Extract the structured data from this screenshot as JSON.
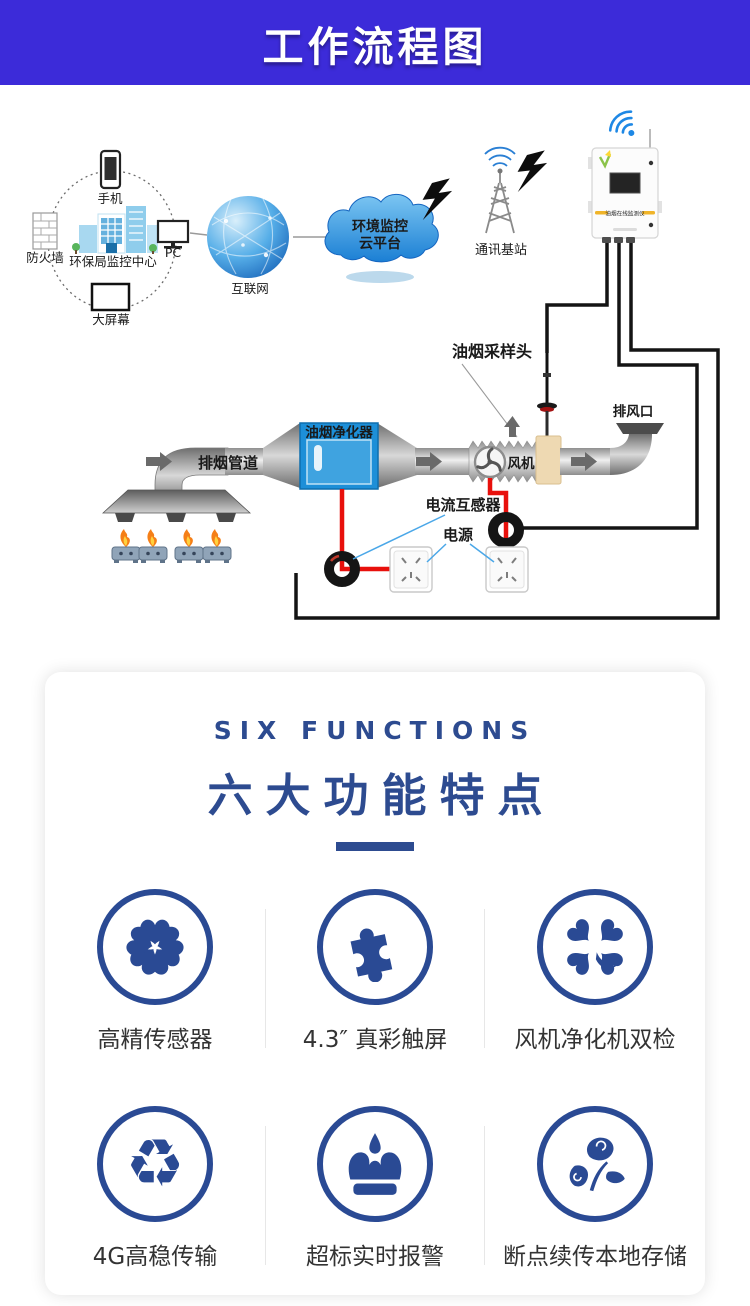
{
  "header": {
    "title": "工作流程图"
  },
  "diagram": {
    "labels": {
      "phone": "手机",
      "firewall": "防火墙",
      "monitor_center": "环保局监控中心",
      "pc": "PC",
      "big_screen": "大屏幕",
      "internet": "互联网",
      "cloud_line1": "环境监控",
      "cloud_line2": "云平台",
      "base_station": "通讯基站",
      "device_band": "油烟在线监测仪",
      "sampling_head": "油烟采样头",
      "exhaust_outlet": "排风口",
      "exhaust_duct": "排烟管道",
      "purifier": "油烟净化器",
      "fan": "风机",
      "current_transformer": "电流互感器",
      "power": "电源"
    }
  },
  "six_functions": {
    "subtitle": "SIX FUNCTIONS",
    "title": "六大功能特点",
    "items": [
      {
        "label": "高精传感器",
        "icon": "fan-flower-icon"
      },
      {
        "label": "4.3″ 真彩触屏",
        "icon": "puzzle-icon"
      },
      {
        "label": "风机净化机双检",
        "icon": "clover-icon"
      },
      {
        "label": "4G高稳传输",
        "icon": "recycle-icon"
      },
      {
        "label": "超标实时报警",
        "icon": "crown-icon"
      },
      {
        "label": "断点续传本地存储",
        "icon": "leaf-icon"
      }
    ],
    "recycle_glyph": "♻"
  },
  "colors": {
    "banner_blue": "#3c2bd9",
    "navy": "#2a4a94",
    "purifier_blue": "#1d8fd8",
    "wire_red": "#e8100c",
    "pointer_blue": "#4aa7e8"
  }
}
